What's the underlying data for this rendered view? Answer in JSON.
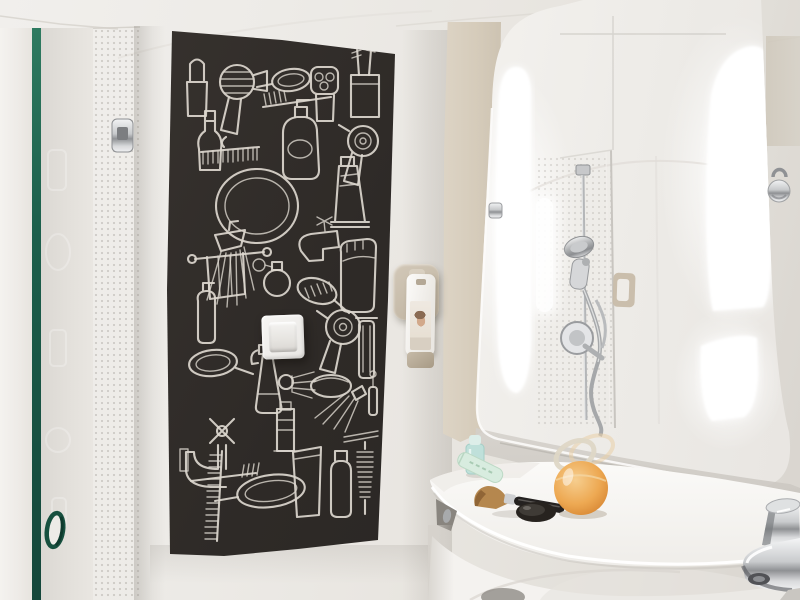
{
  "meta": {
    "title": "Hotel bathroom — chalkboard toiletries art, backlit mirror and basin",
    "type": "photograph",
    "alt": "Bright white hotel bathroom: glass shower screen with green-edged panel on the left, a dark chalkboard wall panel covered in white line drawings of toiletries with a white light switch mounted on it, a wall soap dispenser, a large rounded mirror with vertical backlit light strips reflecting a chrome shower column, a chrome towel hook, and a curved white washbasin counter holding toiletries with a chrome tap at lower right."
  },
  "theme": {
    "wall": "#edeae6",
    "wall-shadow": "#d8d4cf",
    "panel-bg": "#2e2a27",
    "chalk": "#dcd7ce",
    "glass-green": "#1c5f4c",
    "beige": "#d5cbba",
    "mirror-bg": "#f5f3f0",
    "glow": "#ffffff",
    "chrome": "#aeb0b2",
    "chrome-dark": "#737578",
    "counter": "#f6f5f2",
    "dispenser-beige": "#bfb3a0",
    "amber": "#eeb166",
    "mint": "#bfe0da",
    "brush-tan": "#b5874e",
    "black-item": "#232019"
  },
  "objects": {
    "shower_screen": {
      "label": "Glass shower screen with green glass edge, finger-pull hole and chrome hinge"
    },
    "chalk_panel": {
      "label": "Black chalkboard panel with white line drawings of toiletries"
    },
    "light_switch": {
      "label": "White rocker light switch mounted on the chalkboard panel"
    },
    "soap_dispenser": {
      "label": "Wall-mounted soap dispenser bottle with portrait label"
    },
    "mirror": {
      "label": "Large rounded-corner mirror with integrated vertical light strips"
    },
    "mirror_reflection": {
      "label": "Reflection of shower column with hand shower, coiled hose and round mixer valve"
    },
    "light_strips": {
      "label": "Vertical backlit light panels beside the mirror"
    },
    "towel_hook": {
      "label": "Chrome towel hook on the right wall"
    },
    "vanity": {
      "label": "Curved white washbasin counter with toiletries"
    },
    "tap": {
      "label": "Chrome basin tap at lower right"
    }
  },
  "chalk_art": {
    "panel_color": "#2e2a27",
    "stroke_color": "#dcd7ce",
    "items": [
      "lipstick",
      "hair-dryer-side",
      "hand-mirror-small",
      "toothbrush-horizontal",
      "electric-shaver",
      "toothbrush-cup",
      "perfume-flask",
      "comb-horizontal",
      "lotion-bottle",
      "hair-dryer-front",
      "round-mirror",
      "toothpaste-tube",
      "shower-head",
      "towel-on-rail",
      "side-tap",
      "atomizer",
      "hair-brush",
      "storage-jar",
      "pump-bottle",
      "hair-dryer-round",
      "razor",
      "hand-mirror-medium",
      "spray-bottle",
      "shaving-brush",
      "soap-bar",
      "mascara",
      "shower-spray",
      "cross-handle-tap",
      "comb-vertical",
      "toothbrush-2",
      "hand-mirror-large",
      "toothpaste-tube-2",
      "drinking-glass",
      "shampoo-bottle",
      "bottle-brush",
      "shelf-lines"
    ]
  },
  "counter_items": [
    {
      "name": "mint-travel-bottle",
      "color": "#bfe0da"
    },
    {
      "name": "mint-tube",
      "color": "#d8ecdf"
    },
    {
      "name": "makeup-brush",
      "handle_color": "#242120",
      "bristle_color": "#b5874e"
    },
    {
      "name": "black-compact",
      "color": "#232019"
    },
    {
      "name": "amber-perfume-bottle",
      "color": "#eeb166"
    }
  ]
}
